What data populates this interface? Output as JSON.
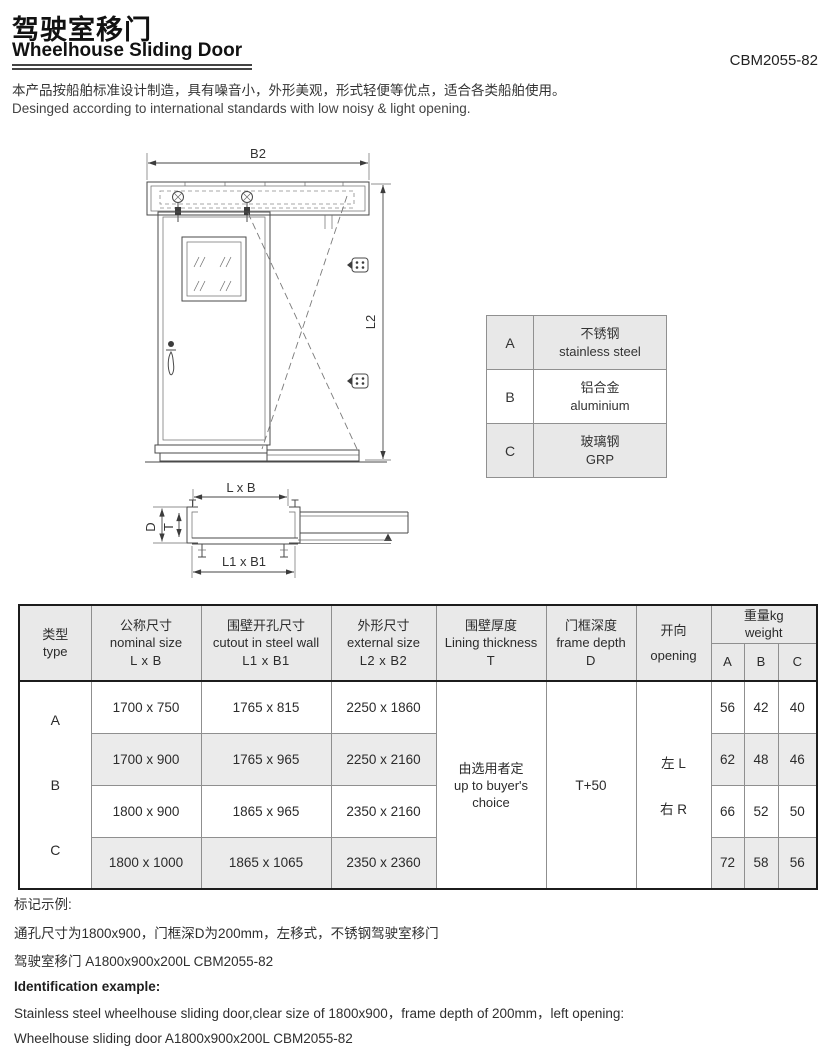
{
  "header": {
    "title_cn": "驾驶室移门",
    "title_en": "Wheelhouse Sliding Door",
    "model": "CBM2055-82",
    "desc_cn": "本产品按船舶标准设计制造，具有噪音小，外形美观，形式轻便等优点，适合各类船舶使用。",
    "desc_en": "Desinged according to international standards with low noisy & light opening."
  },
  "drawing": {
    "front_width_dim": "B2",
    "front_height_dim": "L2",
    "section_top_dim": "L x B",
    "section_bottom_dim": "L1 x B1",
    "section_depth_dim": "D",
    "section_thickness_dim": "T"
  },
  "material_table": {
    "rows": [
      {
        "code": "A",
        "name_cn": "不锈钢",
        "name_en": "stainless steel"
      },
      {
        "code": "B",
        "name_cn": "铝合金",
        "name_en": "aluminium"
      },
      {
        "code": "C",
        "name_cn": "玻璃钢",
        "name_en": "GRP"
      }
    ]
  },
  "spec_table": {
    "headers": {
      "type_cn": "类型",
      "type_en": "type",
      "nominal_cn": "公称尺寸",
      "nominal_en": "nominal size",
      "nominal_sym": "L x B",
      "cutout_cn": "围壁开孔尺寸",
      "cutout_en": "cutout in steel wall",
      "cutout_sym": "L1 x B1",
      "external_cn": "外形尺寸",
      "external_en": "external size",
      "external_sym": "L2 x B2",
      "lining_cn": "围壁厚度",
      "lining_en": "Lining thickness",
      "lining_sym": "T",
      "depth_cn": "门框深度",
      "depth_en": "frame depth",
      "depth_sym": "D",
      "opening_cn": "开向",
      "opening_en": "opening",
      "weight_cn": "重量kg",
      "weight_en": "weight",
      "weight_sub_a": "A",
      "weight_sub_b": "B",
      "weight_sub_c": "C"
    },
    "type_letters": {
      "a": "A",
      "b": "B",
      "c": "C"
    },
    "rows": [
      {
        "nominal": "1700 x 750",
        "cutout": "1765 x 815",
        "external": "2250 x 1860",
        "wa": "56",
        "wb": "42",
        "wc": "40"
      },
      {
        "nominal": "1700 x 900",
        "cutout": "1765 x 965",
        "external": "2250 x 2160",
        "wa": "62",
        "wb": "48",
        "wc": "46"
      },
      {
        "nominal": "1800 x 900",
        "cutout": "1865 x 965",
        "external": "2350 x 2160",
        "wa": "66",
        "wb": "52",
        "wc": "50"
      },
      {
        "nominal": "1800 x 1000",
        "cutout": "1865 x 1065",
        "external": "2350 x 2360",
        "wa": "72",
        "wb": "58",
        "wc": "56"
      }
    ],
    "merged": {
      "lining_line1": "由选用者定",
      "lining_line2": "up to buyer's",
      "lining_line3": "choice",
      "depth_value": "T+50",
      "opening_left": "左 L",
      "opening_right": "右 R"
    }
  },
  "footer": {
    "cn_title": "标记示例:",
    "cn_line1": "通孔尺寸为1800x900，门框深D为200mm，左移式，不锈钢驾驶室移门",
    "cn_line2": "驾驶室移门 A1800x900x200L CBM2055-82",
    "en_title": "Identification example:",
    "en_line1": "Stainless steel wheelhouse sliding door,clear size of 1800x900，frame depth of 200mm，left opening:",
    "en_line2": "Wheelhouse sliding door A1800x900x200L CBM2055-82"
  },
  "colors": {
    "header_shade": "#e9e9e9",
    "row_shade": "#ebebeb",
    "grid_line": "#8f8f8f",
    "outer_border": "#1c1c1c"
  }
}
